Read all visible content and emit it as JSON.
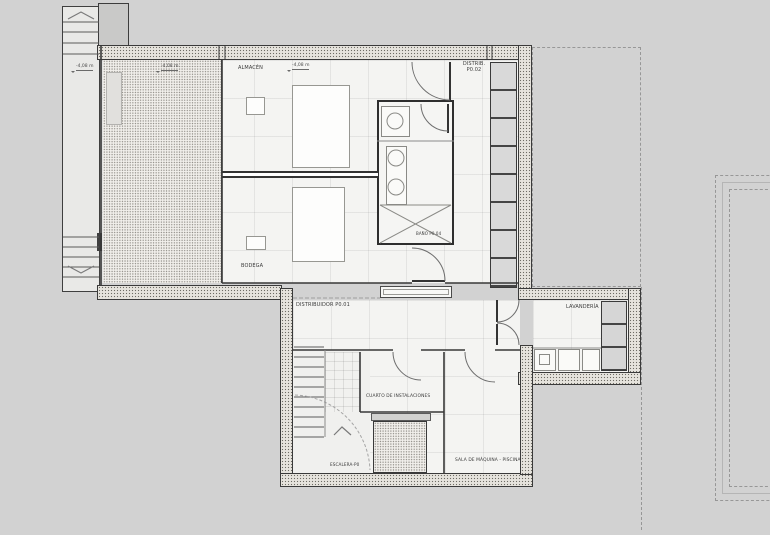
{
  "drawing": {
    "type": "basement floor plan"
  },
  "rooms": {
    "almacen": "ALMACÉN",
    "distrib2_line1": "DISTRIB.",
    "distrib2_line2": "P0.02",
    "bodega": "BODEGA",
    "bano": "BAÑO P0.04",
    "distribuidor1": "DISTRIBUIDOR P0.01",
    "lavanderia": "LAVANDERÍA",
    "cuarto": "CUARTO DE INSTALACIONES",
    "sala": "SALA DE MÁQUINA - PISCINA",
    "escalera": "ESCALERA-P0"
  },
  "levels": {
    "m1": "-4,08 m",
    "m2": "-4,08 m",
    "m3": "-4,08 m"
  },
  "colors": {
    "canvas": "#d2d2d2",
    "wall_line": "#3a3a3a",
    "wall_fill": "#e6e3dd",
    "floor": "#f4f4f2",
    "shelf_fill": "#d9d9d9",
    "dashed_line": "#979797"
  }
}
